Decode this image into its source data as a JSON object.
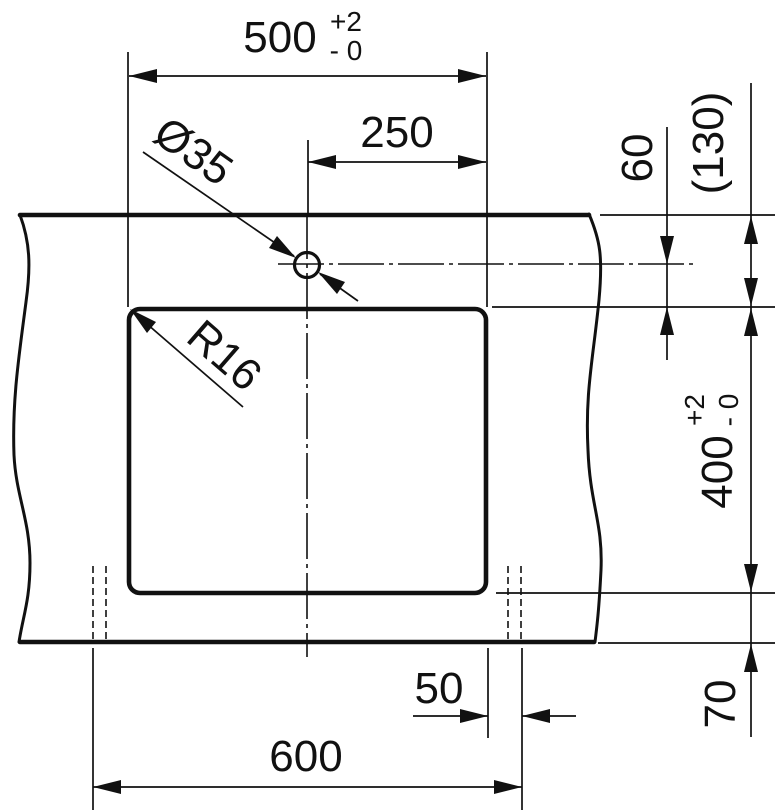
{
  "drawing": {
    "ink_color": "#111111",
    "background_color": "#ffffff",
    "dim_500": {
      "value": "500",
      "tol_plus": "+2",
      "tol_minus": "- 0"
    },
    "dim_250": {
      "value": "250"
    },
    "hole_diameter": {
      "value": "Ø35"
    },
    "corner_radius": {
      "value": "R16"
    },
    "dim_60": {
      "value": "60"
    },
    "dim_130": {
      "value": "(130)"
    },
    "dim_400": {
      "value": "400",
      "tol_plus": "+2",
      "tol_minus": "- 0"
    },
    "dim_70": {
      "value": "70"
    },
    "dim_50": {
      "value": "50"
    },
    "dim_600": {
      "value": "600"
    }
  }
}
